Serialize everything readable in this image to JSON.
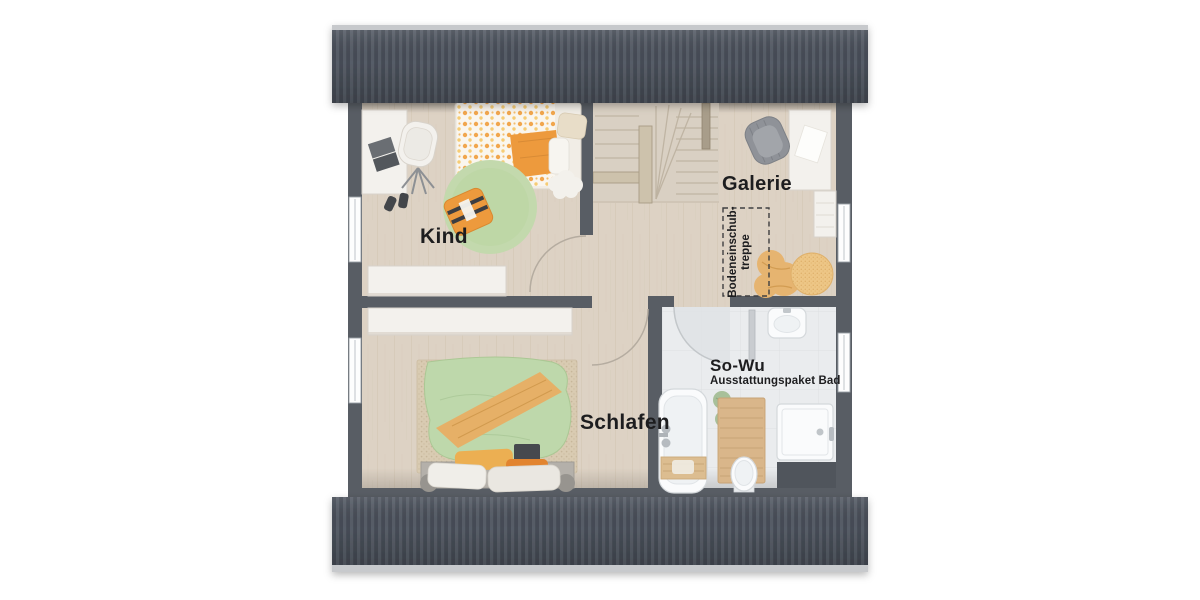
{
  "plan": {
    "type": "attic-floor-plan",
    "labels": {
      "room_kind": "Kind",
      "room_galerie": "Galerie",
      "room_schlafen": "Schlafen",
      "bath_package_title": "So-Wu",
      "bath_package_subtitle": "Ausstattungspaket Bad",
      "attic_ladder_line1": "Bodeneinschub-",
      "attic_ladder_line2": "treppe"
    },
    "colors": {
      "roof_dark": "#454b55",
      "roof_light_rib": "#575d67",
      "roof_edge": "#c7c9cc",
      "wall": "#585d64",
      "floor_wood": "#ddd2c4",
      "floor_bath": "#eaecee",
      "stair_wood": "#d9d0c3",
      "rug_green": "#c3d9ad",
      "duvet_green": "#bed8ab",
      "accent_orange": "#ed9a3d",
      "throw_orange": "#e6b067",
      "beanbag_tan": "#e6b470",
      "bed_carpet": "#d9cbb2",
      "wood_mat": "#d9b68a",
      "label_text": "#1d1d1f"
    }
  }
}
